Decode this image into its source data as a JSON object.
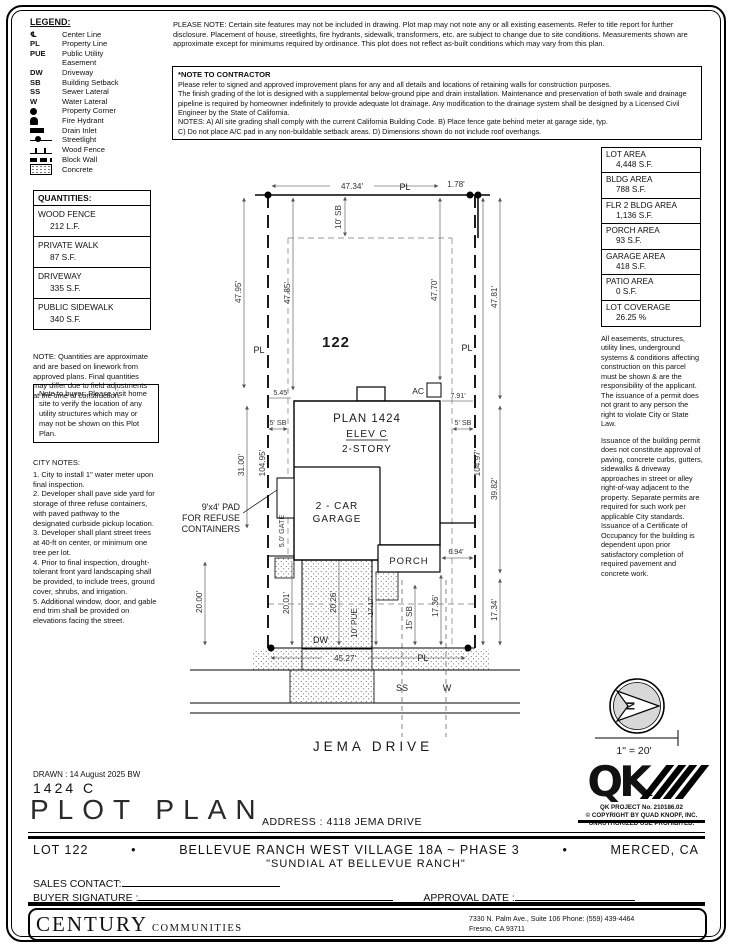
{
  "legend": {
    "title": "LEGEND:",
    "items": [
      {
        "sym": "℄",
        "label": "Center Line"
      },
      {
        "sym": "PL",
        "label": "Property Line"
      },
      {
        "sym": "PUE",
        "label": "Public Utility"
      },
      {
        "sym": "",
        "label": "Easement"
      },
      {
        "sym": "DW",
        "label": "Driveway"
      },
      {
        "sym": "SB",
        "label": "Building Setback"
      },
      {
        "sym": "SS",
        "label": "Sewer Lateral"
      },
      {
        "sym": "W",
        "label": "Water Lateral"
      },
      {
        "sym": "",
        "label": "Property Corner"
      },
      {
        "sym": "",
        "label": "Fire Hydrant"
      },
      {
        "sym": "",
        "label": "Drain Inlet"
      },
      {
        "sym": "",
        "label": "Streetlight"
      },
      {
        "sym": "",
        "label": "Wood Fence"
      },
      {
        "sym": "",
        "label": "Block Wall"
      },
      {
        "sym": "",
        "label": "Concrete"
      }
    ]
  },
  "notes": {
    "please_note": "PLEASE NOTE:  Certain site features may not be included in drawing. Plot map may not note any or all existing easements. Refer to title report for further disclosure. Placement of house, streetlights, fire hydrants, sidewalk, transformers, etc. are subject to change due to site conditions. Measurements shown are approximate except for minimums required by ordinance. This plot does not reflect as-built conditions which may vary from this plan.",
    "contractor_title": "*NOTE TO CONTRACTOR",
    "contractor_body_1": "Please refer to signed and approved improvement plans for any and all details and locations of retaining walls for construction purposes.",
    "contractor_body_2": "The finish grading of the lot is designed with a supplemental below-ground pipe and drain installation. Maintenance and preservation of both swale and drainage pipeline is required by homeowner indefinitely to provide adequate lot drainage. Any modification to the drainage system shall be designed by a Licensed Civil Engineer by the State of California.",
    "contractor_body_3": "NOTES:  A) All site grading shall comply with the current California Building Code.  B) Place fence gate behind meter at garage side, typ.",
    "contractor_body_4": "C) Do not place A/C pad in any non-buildable setback areas.  D) Dimensions shown do not include roof overhangs.",
    "quantities_note": "NOTE: Quantities are approximate and are based on linework from approved plans.  Final quantities may differ due to field adjustments at the time of construction.",
    "buyer_note": "Note to buyer: Please visit home site to verify the location of any utility structures which may or may not be shown on this Plot Plan.",
    "city_title": "CITY NOTES:",
    "city_items": [
      "1. City to install 1\" water meter upon final inspection.",
      "2. Developer shall pave side yard for storage of three refuse containers, with paved pathway to the designated curbside pickup location.",
      "3. Developer shall plant street trees at 40-ft on center, or minimum one tree per lot.",
      "4. Prior to final inspection, drought-tolerant front yard landscaping shall be provided, to include trees, ground cover, shrubs, and irrigation.",
      "5. Additional window, door, and gable end trim shall be provided on elevations facing the street."
    ],
    "right_note_1": "All easements, structures, utility lines, underground systems & conditions affecting construction on this parcel must be shown & are the responsibility of the applicant. The issuance of a permit does not grant to any person the right to violate City or State Law.",
    "right_note_2": "Issuance of the building permit does not constitute approval of paving, concrete curbs, gutters, sidewalks & driveway approaches in street or alley right-of-way adjacent to the property. Separate permits are required for such work per applicable City standards. Issuance of a Certificate of Occupancy for the building is dependent upon prior satisfactory completion of required pavement and concrete work."
  },
  "quantities": {
    "title": "QUANTITIES:",
    "rows": [
      {
        "label": "WOOD FENCE",
        "value": "212 L.F."
      },
      {
        "label": "PRIVATE WALK",
        "value": "87 S.F."
      },
      {
        "label": "DRIVEWAY",
        "value": "335 S.F."
      },
      {
        "label": "PUBLIC SIDEWALK",
        "value": "340 S.F."
      }
    ]
  },
  "areas": {
    "rows": [
      {
        "label": "LOT AREA",
        "value": "4,448 S.F."
      },
      {
        "label": "BLDG AREA",
        "value": "788 S.F."
      },
      {
        "label": "FLR 2 BLDG AREA",
        "value": "1,136 S.F."
      },
      {
        "label": "PORCH AREA",
        "value": "93 S.F."
      },
      {
        "label": "GARAGE AREA",
        "value": "418 S.F."
      },
      {
        "label": "PATIO AREA",
        "value": "0 S.F."
      },
      {
        "label": "LOT COVERAGE",
        "value": "26.25 %"
      }
    ]
  },
  "plot": {
    "lot_number": "122",
    "plan_line1": "PLAN 1424",
    "plan_line2": "ELEV C",
    "plan_line3": "2-STORY",
    "garage_line1": "2 - CAR",
    "garage_line2": "GARAGE",
    "porch": "PORCH",
    "ac": "AC",
    "dw": "DW",
    "pad_line1": "9'x4' PAD",
    "pad_line2": "FOR REFUSE",
    "pad_line3": "CONTAINERS",
    "street_name": "JEMA DRIVE",
    "ss": "SS",
    "w": "W",
    "pl": "PL",
    "north": "N",
    "scale": "1\" = 20'",
    "dims": {
      "top_width": "47.34'",
      "jog": "1.78'",
      "sb_top": "10' SB",
      "left_outer": "47.95'",
      "left_inner": "47.85'",
      "left_mid": "31.00'",
      "left_bottom": "20.00'",
      "left_depth": "104.95'",
      "left_offset": "5.45'",
      "sb_left": "5' SB",
      "sb_right": "5' SB",
      "right_house": "47.70'",
      "right_outer_top": "47.81'",
      "right_depth": "104.97'",
      "right_mid": "39.82'",
      "right_bottom": "17.34'",
      "ac_offset": "7.91'",
      "gate": "5.0' GATE",
      "porch_offset": "6.94'",
      "drive_left": "20.01'",
      "drive_width": "20.26'",
      "pue": "10' PUE",
      "walk": "17.17'",
      "sb_front": "15' SB",
      "front_right": "17.36'",
      "bottom_width": "45.27'"
    }
  },
  "titleblock": {
    "drawn": "DRAWN :  14 August 2025  BW",
    "plan_number": "1424  C",
    "sheet_title": "PLOT PLAN",
    "address": "ADDRESS :  4118 JEMA DRIVE"
  },
  "qk": {
    "logo": "QK",
    "project": "QK PROJECT No. 210186.02",
    "copyright1": "© COPYRIGHT BY QUAD KNOPF, INC.",
    "copyright2": "UNAUTHORIZED USE PROHIBITED."
  },
  "strip": {
    "lot": "LOT 122",
    "bullet": "•",
    "community": "BELLEVUE RANCH WEST VILLAGE 18A ~ PHASE 3",
    "city": "MERCED, CA",
    "subtitle": "\"SUNDIAL AT BELLEVUE RANCH\"",
    "sales_label": "SALES CONTACT:",
    "signature_label": "BUYER SIGNATURE :",
    "approval_label": "APPROVAL DATE :"
  },
  "footer": {
    "brand_primary": "CENTURY",
    "brand_secondary": "COMMUNITIES",
    "address1": "7330 N. Palm Ave., Suite 106    Phone:  (559) 439-4464",
    "address2": "Fresno, CA  93711"
  }
}
